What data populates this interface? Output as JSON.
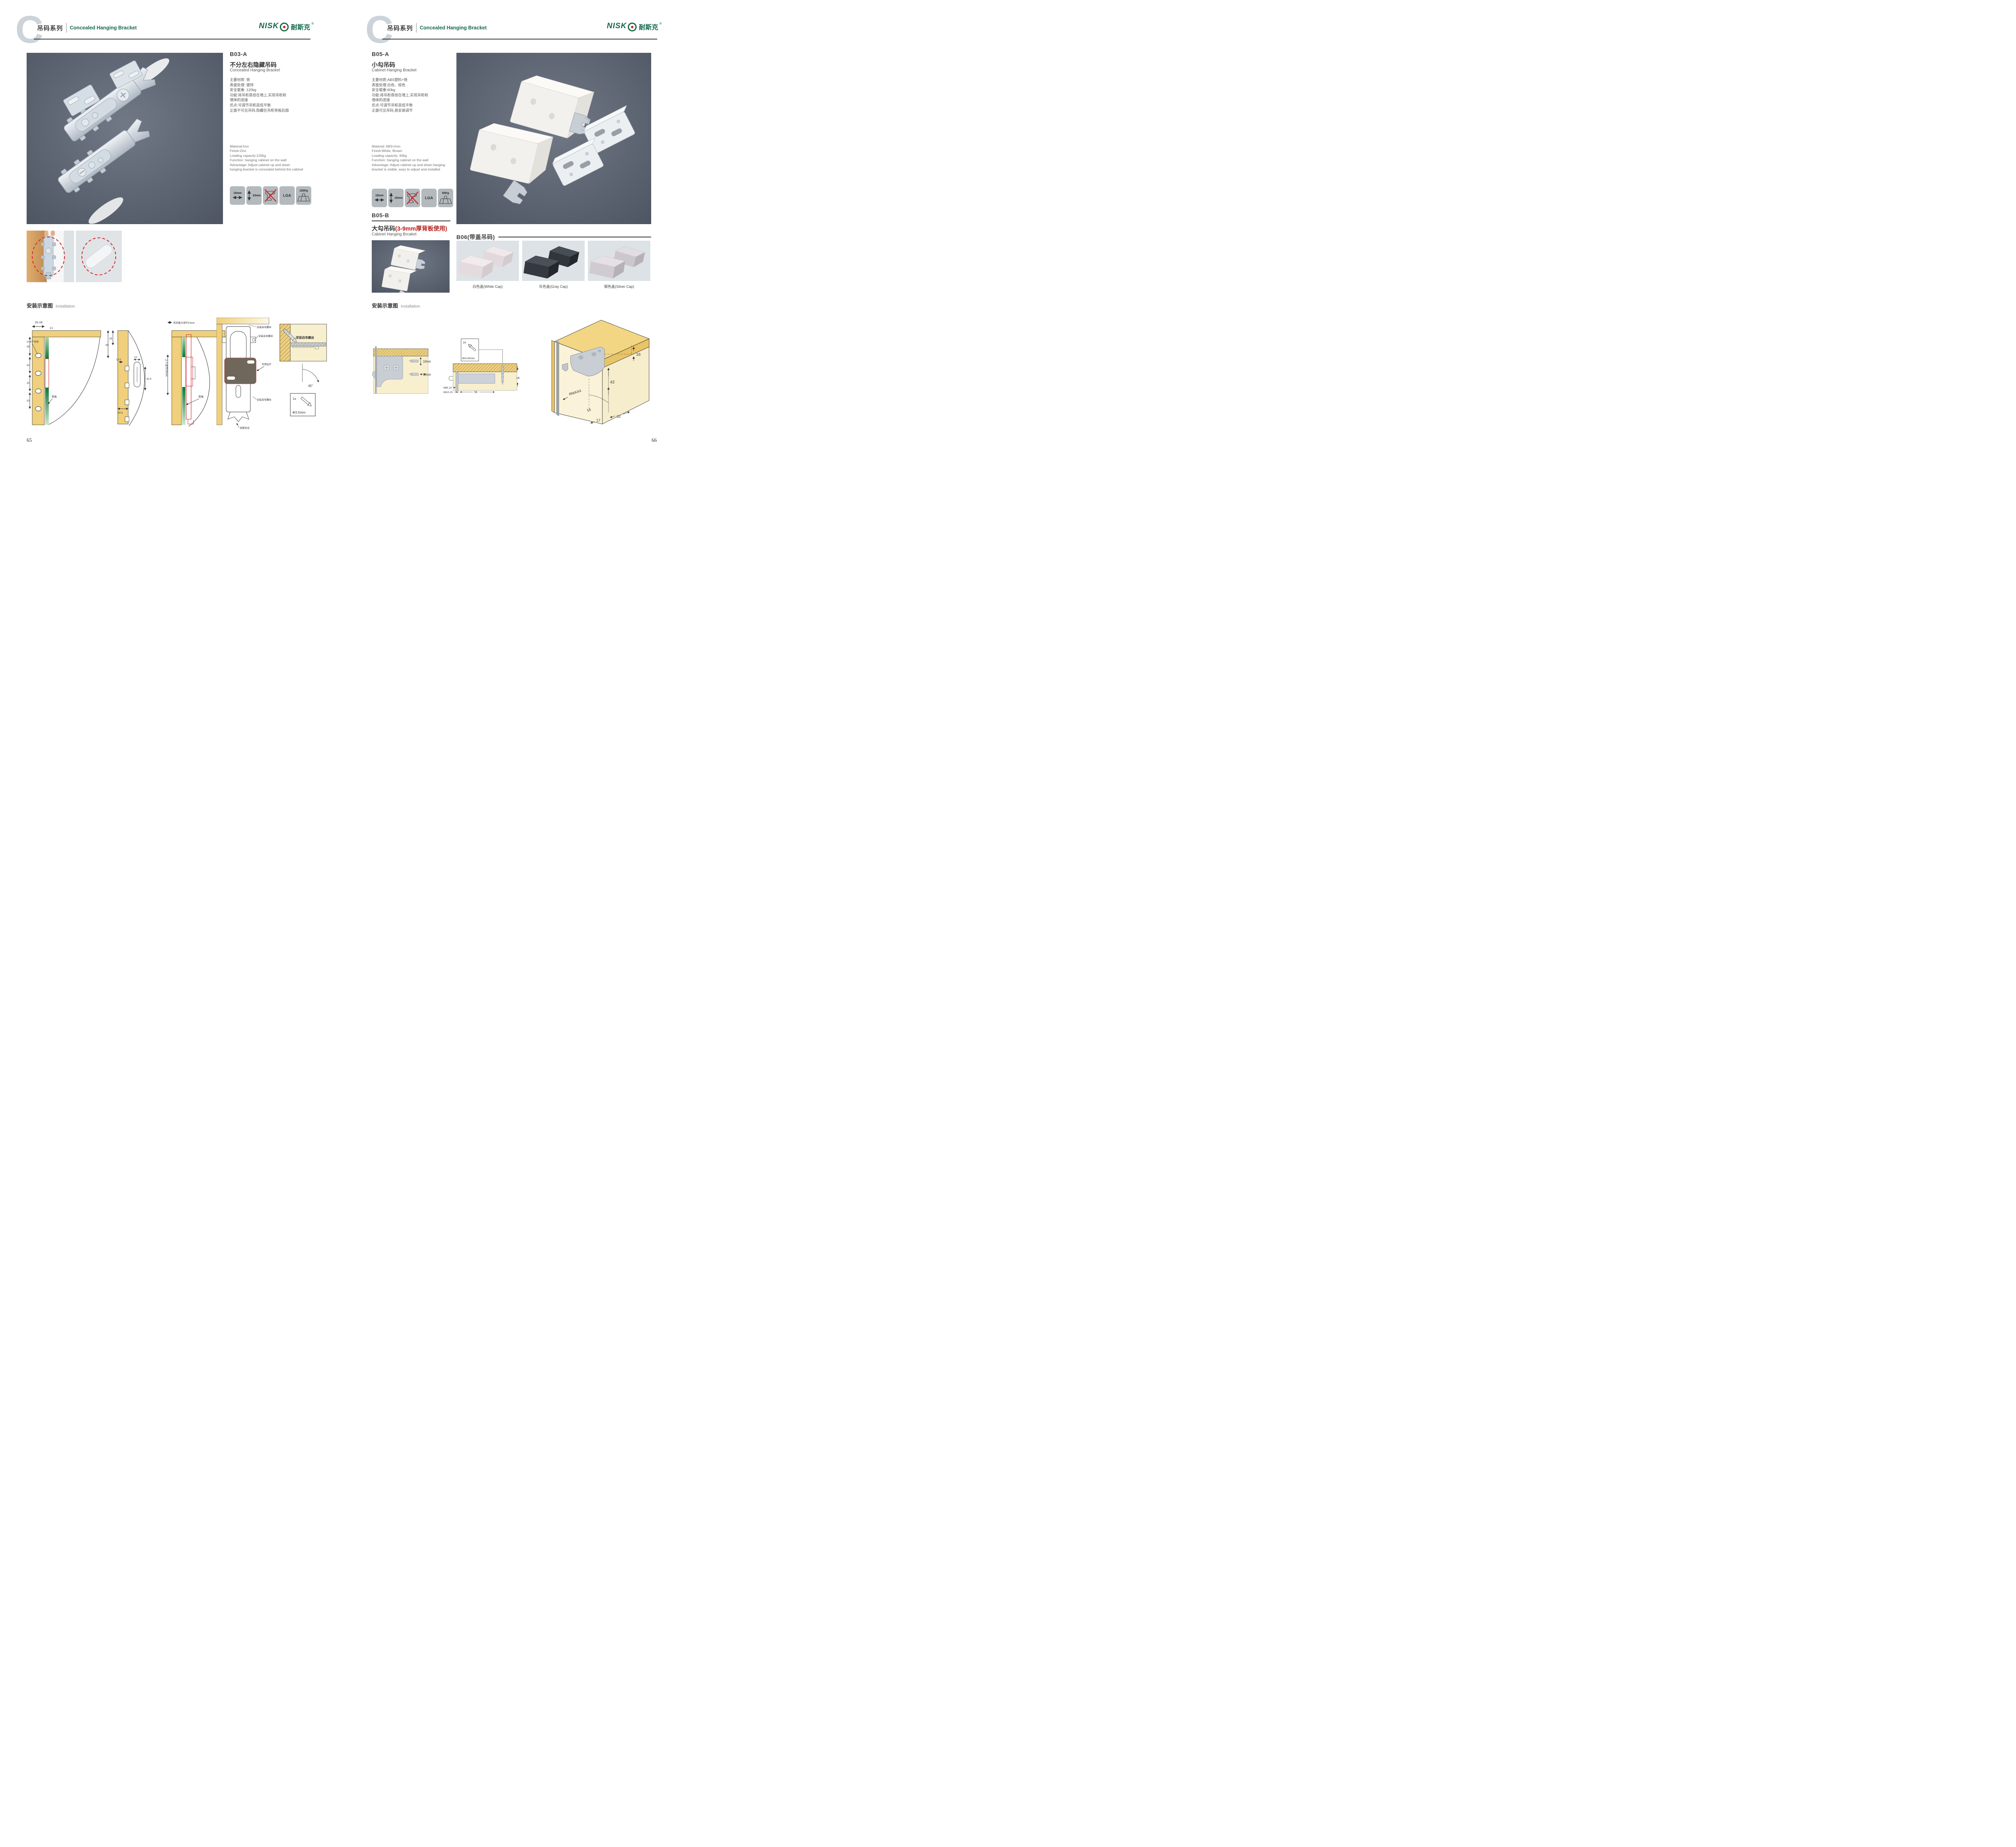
{
  "header": {
    "letter": "C",
    "series_zh": "吊码系列",
    "series_en": "Concealed Hanging Bracket",
    "brand": {
      "name_part": "NISK",
      "name_zh": "耐斯克",
      "reg": "®"
    }
  },
  "colors": {
    "brand_green": "#17694a",
    "accent_red": "#b7221f",
    "photo_bg": "#59616f",
    "wood_yellow": "#f0d07c"
  },
  "page_left": {
    "page_number": "65",
    "product": {
      "code": "B03-A",
      "title_zh": "不分左右隐藏吊码",
      "title_en": "Concealed Hanging Bracket",
      "specs_zh": [
        "主要材质: 铁",
        "表面处理: 镀锌",
        "安全载重: 120kg",
        "功能:将吊柜悬挂在墙上,实现吊柜和",
        "墙体的连接",
        "优点:可调节吊柜高低平衡",
        "正面不可见吊码,隐藏在吊柜背板后面"
      ],
      "specs_en": [
        "Material:Iron",
        "Finish:Zinc",
        "Loading capacity:120kg",
        "Function: hanging cabinet on the wall",
        "Advantage: Adjust cabinet up and down",
        "hanging bracket is concealed behind the cabinet"
      ],
      "badges": [
        {
          "label": "10mm",
          "icon": "width-arrow-icon"
        },
        {
          "label": "10mm",
          "icon": "height-arrow-icon"
        },
        {
          "label": "",
          "icon": "no-drill-icon"
        },
        {
          "label": "LGA",
          "icon": "lga-badge"
        },
        {
          "label": "120Kg",
          "icon": "load-capacity-icon"
        }
      ]
    },
    "installation": {
      "title_zh": "安装示意图",
      "title_en": "Installation",
      "d1": {
        "dim_top": "16-18",
        "dim_small": "3.5",
        "dim_35": "35",
        "dim_32a": "32",
        "dim_32b": "32",
        "dim_32c": "32",
        "holes_label": "10-4个均布",
        "back_label": "背板"
      },
      "d2": {
        "dim_35": "35",
        "dim_60": "60",
        "dim_125": "12.5",
        "dim_12": "12",
        "dim_425": "42.5",
        "dim_205": "20.5"
      },
      "d3": {
        "top_label": "前后最大调节10mm",
        "side_label": "上下调节10mm",
        "back_label": "背板"
      },
      "d4": {
        "screw1": "安装自攻螺丝",
        "screw2": "安装自攻螺丝",
        "plate": "专用挂片",
        "screw3": "安装自攻螺丝",
        "lock": "锁紧状态"
      },
      "d5": {
        "screw": "安装自攻螺丝",
        "angle": "45°",
        "qty": "1x",
        "dia": "Φ3.5mm"
      }
    }
  },
  "page_right": {
    "page_number": "66",
    "product_a": {
      "code": "B05-A",
      "title_zh": "小勾吊码",
      "title_en": "Cabinet Hanging Bracket",
      "specs_zh": [
        "主要材质:ABS塑料+铁",
        "表面处理:白色、棕色",
        "安全载重:60kg",
        "功能:将吊柜悬挂在墙上,实现吊柜和",
        "墙体的连接",
        "优点:可调节吊柜高低平衡",
        "正面可见吊码,易安装调节"
      ],
      "specs_en": [
        "Material: ABS+Iron",
        "Finish:White, Brown",
        "Loading capacity: 60kg",
        "Function: hanging cabinet on the wall",
        "Advantage: Adjust cabinet up and down hanging",
        "bracket is visible, easy to adjust and installed"
      ],
      "badges": [
        {
          "label": "15mm",
          "icon": "width-arrow-icon"
        },
        {
          "label": "10mm",
          "icon": "height-arrow-icon"
        },
        {
          "label": "",
          "icon": "no-drill-icon"
        },
        {
          "label": "LGA",
          "icon": "lga-badge"
        },
        {
          "label": "60Kg",
          "icon": "load-capacity-icon"
        }
      ]
    },
    "product_b": {
      "code": "B05-B",
      "title_zh": "大勾吊码",
      "title_note": "(3-9mm厚背板使用)",
      "title_en": "Cabinet Hanging Brcaket"
    },
    "product_b06": {
      "code": "B06(带盖吊码)",
      "caps": [
        {
          "label": "白色盖(White Cap)"
        },
        {
          "label": "灰色盖(Gray Cap)"
        },
        {
          "label": "银色盖(Silver Cap)"
        }
      ]
    },
    "installation": {
      "title_zh": "安装示意图",
      "title_en": "Installation",
      "d1": {
        "dim_v": "10mm",
        "dim_h": "15mm"
      },
      "d2": {
        "qty": "2x",
        "dia": "Φ4×30mm",
        "dim_18": "18",
        "min": "MIN.10",
        "max": "MAX.23",
        "dim_58": "58"
      },
      "d3": {
        "dim_16a": "16",
        "dim_42": "42",
        "rmax": "RMAX4",
        "dim_16b": "16",
        "dim_17": "17",
        "dim_32": "32"
      }
    }
  }
}
